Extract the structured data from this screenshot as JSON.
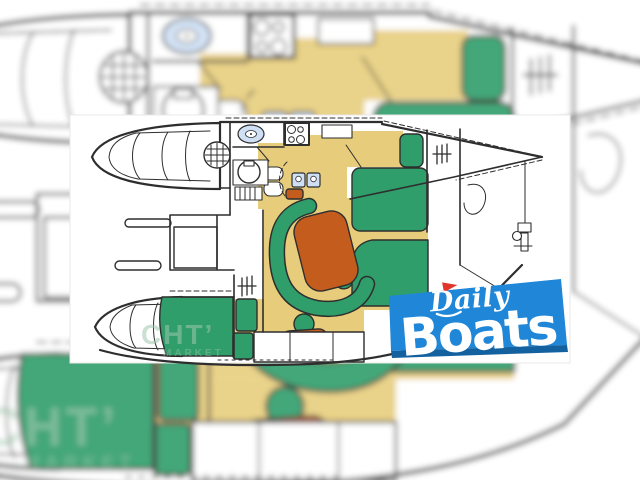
{
  "palette": {
    "paper": "#ffffff",
    "line": "#2e2e2e",
    "floor": "#e7cd7b",
    "cushion": "#2f9e6b",
    "table": "#c45c1e",
    "fixture": "#cfe0f5",
    "watermark": "#9fc7ae",
    "logo_panel": "#1f86d8",
    "logo_band": "#14619f",
    "logo_text": "#ffffff",
    "logo_flag": "#e3362b"
  },
  "logo": {
    "word_top": "Daily",
    "word_bottom": "Boats"
  },
  "watermark": {
    "line1": "CHT’",
    "line2": "MARKET"
  },
  "floorplan": {
    "regions": [
      "port-bow-berth",
      "starboard-bow-berth",
      "galley-stove",
      "galley-oval-sink",
      "galley-double-sink",
      "head-toilet",
      "deck-hatch",
      "companionway-steps",
      "dinette-table",
      "dinette-settee",
      "dinette-stool",
      "aft-berth-headboard",
      "aft-double-berth",
      "mid-double-berth",
      "louver-vents",
      "locker-row",
      "bow-point-rigging"
    ]
  }
}
